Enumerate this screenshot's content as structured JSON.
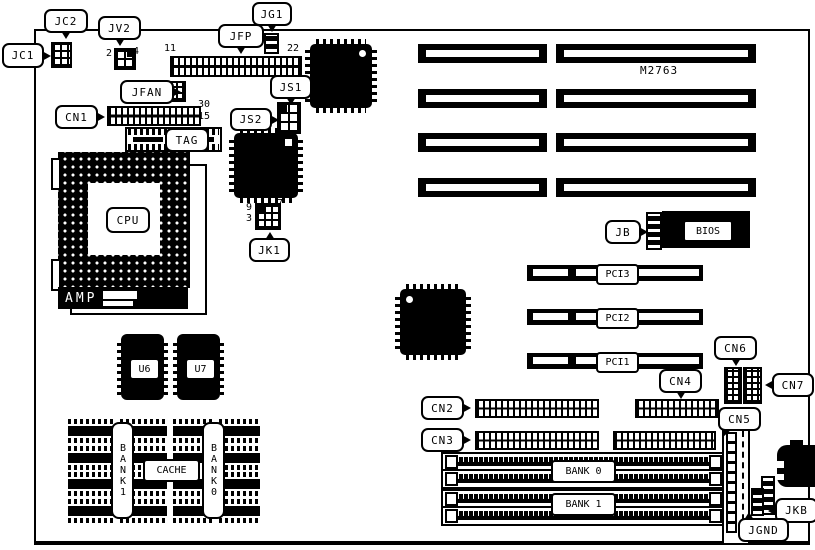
{
  "board": {
    "part_number": "M2763"
  },
  "callouts": {
    "jc1": "JC1",
    "jc2": "JC2",
    "jv2": "JV2",
    "jg1": "JG1",
    "jfp": "JFP",
    "jfan": "JFAN",
    "cn1": "CN1",
    "tag": "TAG",
    "js1": "JS1",
    "js2": "JS2",
    "cpu": "CPU",
    "amp": "AMP",
    "jk1": "JK1",
    "u6": "U6",
    "u7": "U7",
    "cache": "CACHE",
    "bank1_vertical": "BANK1",
    "bank0_vertical": "BANK0",
    "jb": "JB",
    "bios": "BIOS",
    "pci1": "PCI1",
    "pci2": "PCI2",
    "pci3": "PCI3",
    "cn2": "CN2",
    "cn3": "CN3",
    "cn4": "CN4",
    "cn5": "CN5",
    "cn6": "CN6",
    "cn7": "CN7",
    "bank0": "BANK 0",
    "bank1": "BANK 1",
    "jkb": "JKB",
    "jgnd": "JGND"
  },
  "pin_numbers": {
    "jv2_pin2": "2",
    "jv2_pin4": "4",
    "jfp_pin11": "11",
    "jfp_pin22": "22",
    "cn1_pin30": "30",
    "cn1_pin15": "15",
    "jk1_pin9": "9",
    "jk1_pin3": "3",
    "jk1_pin7": "7"
  },
  "colors": {
    "ink": "#000000",
    "paper": "#ffffff"
  }
}
